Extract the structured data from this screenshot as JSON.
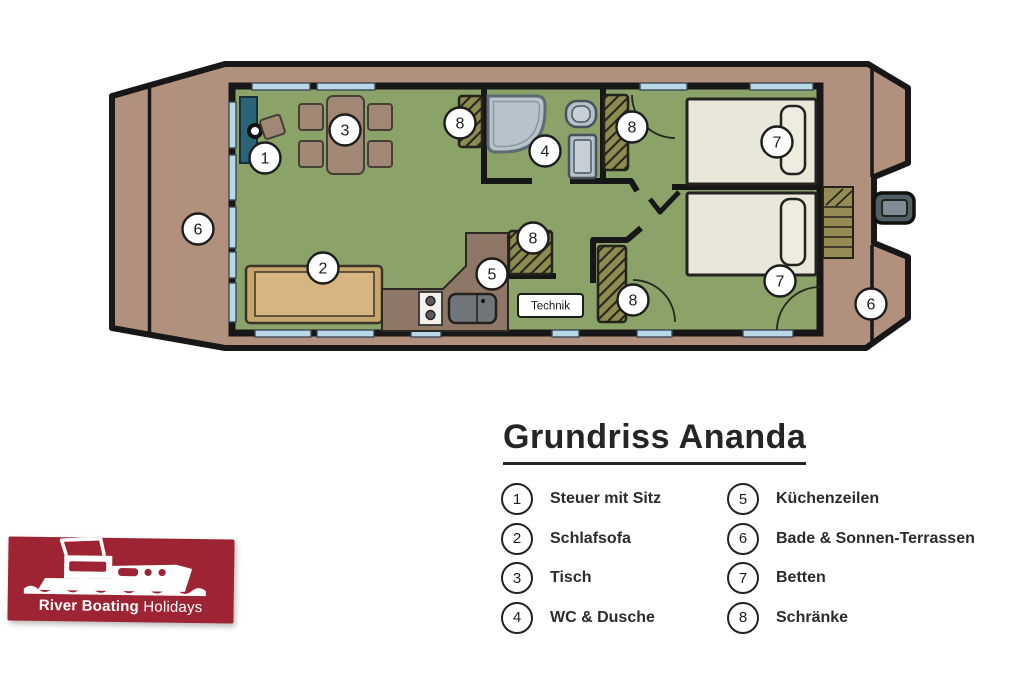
{
  "plan": {
    "technik_label": "Technik",
    "badges": {
      "steering": "1",
      "sofa": "2",
      "table": "3",
      "wc": "4",
      "kitchen": "5",
      "terrace_left": "6",
      "terrace_right": "6",
      "bed_top": "7",
      "bed_bottom": "7",
      "cab_top_left": "8",
      "cab_top_right": "8",
      "cab_mid": "8",
      "cab_bottom": "8"
    }
  },
  "legend": {
    "title": "Grundriss Ananda",
    "items": [
      {
        "num": "1",
        "label": "Steuer mit Sitz"
      },
      {
        "num": "2",
        "label": "Schlafsofa"
      },
      {
        "num": "3",
        "label": "Tisch"
      },
      {
        "num": "4",
        "label": "WC & Dusche"
      },
      {
        "num": "5",
        "label": "Küchenzeilen"
      },
      {
        "num": "6",
        "label": "Bade & Sonnen-Terrassen"
      },
      {
        "num": "7",
        "label": "Betten"
      },
      {
        "num": "8",
        "label": "Schränke"
      }
    ]
  },
  "logo": {
    "brand_bold": "River Boating",
    "brand_regular": "Holidays"
  },
  "colors": {
    "logo_red": "#9e2433",
    "deck_brown": "#b2907e",
    "interior_green": "#8ba269",
    "outline_black": "#171717",
    "window_blue": "#b9d8e7",
    "cabinet_olive": "#8d8b50",
    "furniture_taupe": "#a18874",
    "sofa_tan": "#d6b580",
    "bed_cream": "#e9e6da",
    "console_teal": "#2b6478"
  }
}
